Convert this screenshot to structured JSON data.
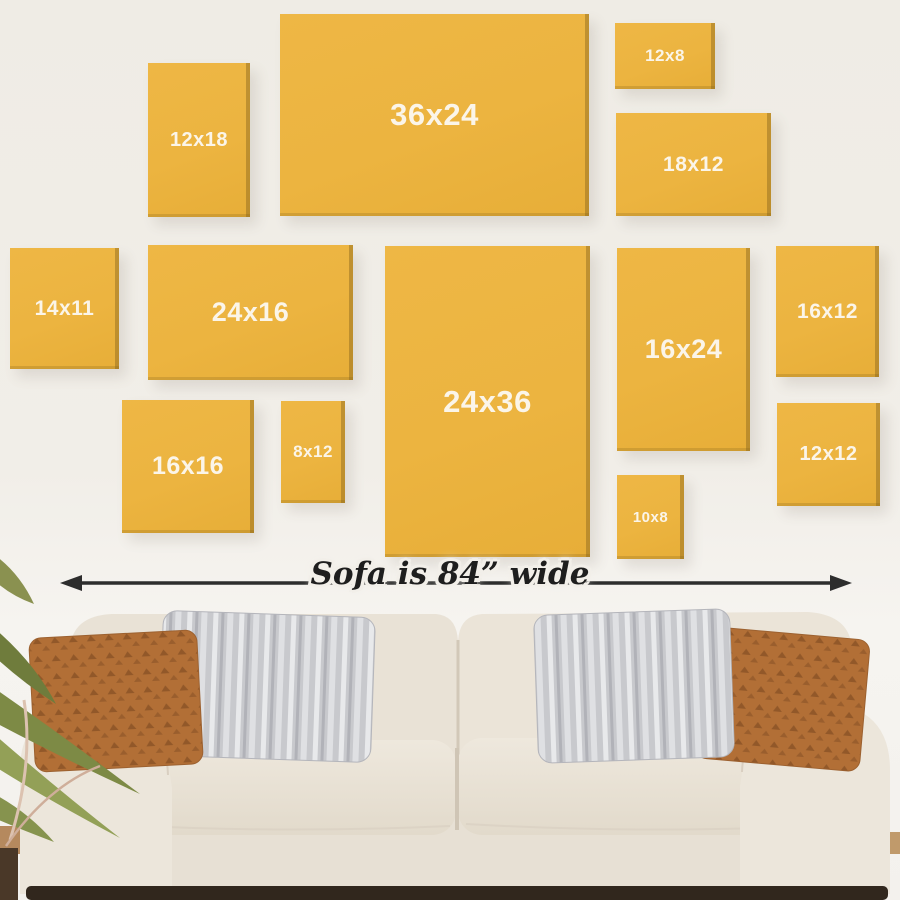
{
  "frames": [
    {
      "label": "12x18",
      "orientation": "portrait"
    },
    {
      "label": "36x24",
      "orientation": "landscape"
    },
    {
      "label": "12x8",
      "orientation": "landscape"
    },
    {
      "label": "18x12",
      "orientation": "landscape"
    },
    {
      "label": "14x11",
      "orientation": "square"
    },
    {
      "label": "24x16",
      "orientation": "landscape"
    },
    {
      "label": "24x36",
      "orientation": "portrait"
    },
    {
      "label": "16x24",
      "orientation": "portrait"
    },
    {
      "label": "16x12",
      "orientation": "portrait"
    },
    {
      "label": "16x16",
      "orientation": "square"
    },
    {
      "label": "8x12",
      "orientation": "portrait"
    },
    {
      "label": "10x8",
      "orientation": "portrait"
    },
    {
      "label": "12x12",
      "orientation": "square"
    }
  ],
  "sofa_annotation": {
    "label": "Sofa is 84” wide",
    "arrow_icon": "double-headed-horizontal-arrow"
  },
  "colors": {
    "canvas_yellow": "#ecb440",
    "canvas_edge_shadow": "#a5812f",
    "wall": "#f1eee8",
    "label_text": "#fbf5e9",
    "arrow": "#2d2d2d",
    "sofa_fabric": "#eae3d7",
    "pillow_rust": "#b26f36",
    "pillow_gray": "#c8c9cd",
    "plant_green": "#7d8a45",
    "floor_shadow": "#31271d"
  }
}
